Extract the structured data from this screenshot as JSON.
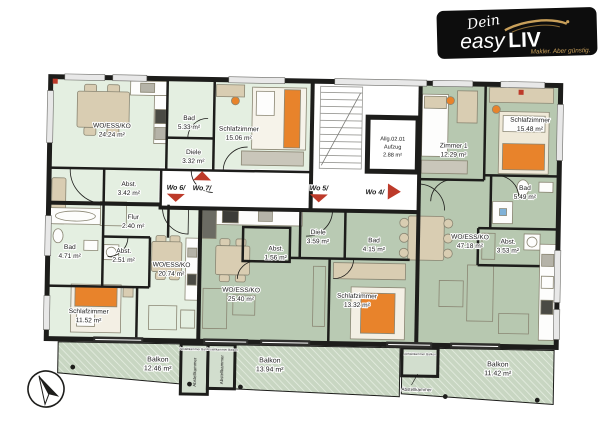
{
  "logo": {
    "script": "Dein",
    "easy": "easy",
    "liv": "LIV",
    "tagline": "Makler. Aber günstig."
  },
  "rooms": {
    "wo7_living": {
      "name": "WO/ESS/KO",
      "area": "24.24 m²"
    },
    "wo7_bad": {
      "name": "Bad",
      "area": "5.33 m²"
    },
    "wo7_diele": {
      "name": "Diele",
      "area": "3.32 m²"
    },
    "wo7_abst": {
      "name": "Abst.",
      "area": "3.42 m²"
    },
    "wo7_schlaf": {
      "name": "Schlafzimmer",
      "area": "15.06 m²"
    },
    "wo4_zimmer1": {
      "name": "Zimmer 1",
      "area": "12.29 m²"
    },
    "wo4_schlaf": {
      "name": "Schlafzimmer",
      "area": "15.48 m²"
    },
    "wo4_bad": {
      "name": "Bad",
      "area": "5.49 m²"
    },
    "wo4_abst": {
      "name": "Abst.",
      "area": "3.53 m²"
    },
    "wo4_living": {
      "name": "WO/ESS/KO",
      "area": "47.18 m²"
    },
    "wo6_flur": {
      "name": "Flur",
      "area": "2.40 m²"
    },
    "wo6_abst": {
      "name": "Abst.",
      "area": "2.51 m²"
    },
    "wo6_bad": {
      "name": "Bad",
      "area": "4.71 m²"
    },
    "wo6_living": {
      "name": "WO/ESS/KO",
      "area": "20.74 m²"
    },
    "wo6_schlaf": {
      "name": "Schlafzimmer",
      "area": "11.52 m²"
    },
    "wo5_living": {
      "name": "WO/ESS/KO",
      "area": "25.40 m²"
    },
    "wo5_abst": {
      "name": "Abst.",
      "area": "1.56 m²"
    },
    "wo5_diele": {
      "name": "Diele",
      "area": "3.59 m²"
    },
    "wo5_bad": {
      "name": "Bad",
      "area": "4.15 m²"
    },
    "wo5_schlaf": {
      "name": "Schlafzimmer",
      "area": "13.32 m²"
    }
  },
  "elevator": {
    "line1": "Allg.02.01",
    "line2": "Aufzug",
    "line3": "2.88 m²"
  },
  "markers": {
    "wo6": "Wo 6/",
    "wo7": "Wo 7/",
    "wo5": "Wo 5/",
    "wo4": "Wo 4/"
  },
  "balconies": {
    "left": {
      "name": "Balkon",
      "area": "12.46 m²"
    },
    "middle": {
      "name": "Balkon",
      "area": "13.94 m²"
    },
    "right": {
      "name": "Balkon",
      "area": "11.42 m²"
    }
  },
  "storage": {
    "label": "Abstellkammer",
    "caption": "Abstellkammer Balkon"
  },
  "colors": {
    "wall": "#1d1d1b",
    "unit_light_green": "#e4efe1",
    "unit_sage_green": "#b7c8b0",
    "balcony_green": "#c8d6c2",
    "accent_orange": "#e8832b",
    "marker_red": "#bd3a2a",
    "logo_gold": "#c9a05a",
    "logo_bg": "#0d0d0d"
  }
}
